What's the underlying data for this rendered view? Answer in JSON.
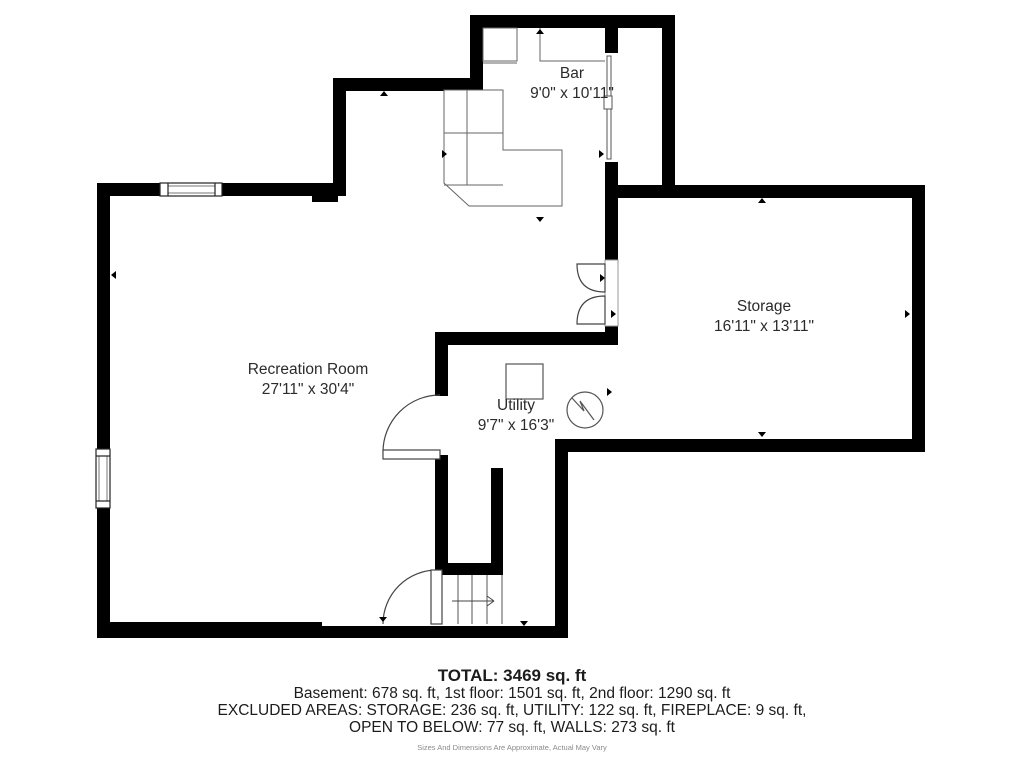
{
  "rooms": [
    {
      "name": "Bar",
      "dimensions": "9'0\" x 10'11\""
    },
    {
      "name": "Storage",
      "dimensions": "16'11\" x 13'11\""
    },
    {
      "name": "Recreation Room",
      "dimensions": "27'11\" x 30'4\""
    },
    {
      "name": "Utility",
      "dimensions": "9'7\" x 16'3\""
    }
  ],
  "summary": {
    "total": "TOTAL: 3469 sq. ft",
    "floors": "Basement: 678 sq. ft, 1st floor: 1501 sq. ft, 2nd floor: 1290 sq. ft",
    "excluded": "EXCLUDED AREAS: STORAGE: 236 sq. ft, UTILITY: 122 sq. ft, FIREPLACE: 9 sq. ft,",
    "open_below": "OPEN TO BELOW: 77 sq. ft, WALLS: 273 sq. ft",
    "disclaimer": "Sizes And Dimensions Are Approximate, Actual May Vary"
  },
  "colors": {
    "wall": "#000000",
    "fixture_line": "#666666",
    "door_line": "#444444",
    "label_text": "#2b2b2b",
    "disclaimer_text": "#8a8a8a"
  }
}
